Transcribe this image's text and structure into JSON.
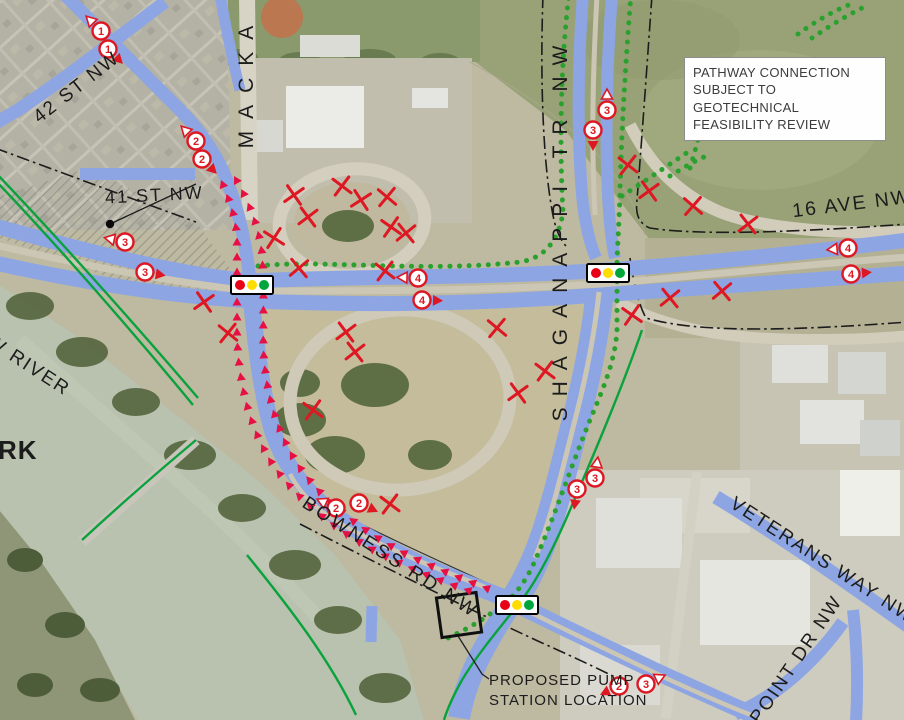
{
  "callout": {
    "lines": [
      "PATHWAY CONNECTION",
      "SUBJECT TO GEOTECHNICAL",
      "FEASIBILITY REVIEW"
    ]
  },
  "street_labels": {
    "st42": "42 ST NW",
    "st41": "41 ST NW",
    "mackay": "MACKA",
    "shaganappi": "SHAGANAPPI TR NW",
    "ave16": "16 AVE NW",
    "bowness": "BOWNESS RD NW",
    "veterans": "VETERANS WAY NW",
    "point": "POINT DR NW",
    "river": "W RIVER",
    "park": "RK"
  },
  "pump_label": {
    "line1": "PROPOSED PUMP",
    "line2": "STATION LOCATION"
  },
  "lane_markers": [
    {
      "n": "1",
      "x": 101,
      "y": 31,
      "a": 315,
      "s": "w"
    },
    {
      "n": "1",
      "x": 108,
      "y": 49,
      "a": 135,
      "s": "r"
    },
    {
      "n": "2",
      "x": 196,
      "y": 141,
      "a": 315,
      "s": "w"
    },
    {
      "n": "2",
      "x": 202,
      "y": 159,
      "a": 135,
      "s": "r"
    },
    {
      "n": "2",
      "x": 336,
      "y": 508,
      "a": 295,
      "s": "w"
    },
    {
      "n": "2",
      "x": 359,
      "y": 503,
      "a": 115,
      "s": "r"
    },
    {
      "n": "2",
      "x": 619,
      "y": 686,
      "a": 245,
      "s": "r"
    },
    {
      "n": "3",
      "x": 646,
      "y": 684,
      "a": 65,
      "s": "w"
    },
    {
      "n": "3",
      "x": 125,
      "y": 242,
      "a": 282,
      "s": "w"
    },
    {
      "n": "3",
      "x": 145,
      "y": 272,
      "a": 100,
      "s": "r"
    },
    {
      "n": "4",
      "x": 418,
      "y": 278,
      "a": 272,
      "s": "w"
    },
    {
      "n": "4",
      "x": 422,
      "y": 300,
      "a": 92,
      "s": "r"
    },
    {
      "n": "4",
      "x": 848,
      "y": 248,
      "a": 265,
      "s": "w"
    },
    {
      "n": "4",
      "x": 851,
      "y": 274,
      "a": 85,
      "s": "r"
    },
    {
      "n": "3",
      "x": 607,
      "y": 110,
      "a": 0,
      "s": "w"
    },
    {
      "n": "3",
      "x": 593,
      "y": 130,
      "a": 180,
      "s": "r"
    },
    {
      "n": "3",
      "x": 595,
      "y": 478,
      "a": 8,
      "s": "w"
    },
    {
      "n": "3",
      "x": 577,
      "y": 489,
      "a": 188,
      "s": "r"
    }
  ],
  "x_marks": [
    [
      294,
      195,
      10
    ],
    [
      342,
      186,
      -8
    ],
    [
      361,
      200,
      12
    ],
    [
      387,
      197,
      -5
    ],
    [
      308,
      217,
      8
    ],
    [
      391,
      227,
      -10
    ],
    [
      406,
      233,
      6
    ],
    [
      274,
      238,
      -12
    ],
    [
      299,
      268,
      5
    ],
    [
      385,
      271,
      -7
    ],
    [
      204,
      302,
      10
    ],
    [
      228,
      333,
      -6
    ],
    [
      346,
      332,
      8
    ],
    [
      313,
      410,
      -9
    ],
    [
      355,
      352,
      7
    ],
    [
      497,
      328,
      -5
    ],
    [
      518,
      393,
      9
    ],
    [
      545,
      371,
      -8
    ],
    [
      670,
      298,
      6
    ],
    [
      632,
      315,
      -10
    ],
    [
      722,
      291,
      5
    ],
    [
      628,
      165,
      -7
    ],
    [
      649,
      191,
      9
    ],
    [
      693,
      206,
      -4
    ],
    [
      748,
      224,
      7
    ],
    [
      390,
      504,
      -8
    ]
  ],
  "signals": [
    {
      "x": 252,
      "y": 285
    },
    {
      "x": 608,
      "y": 273
    },
    {
      "x": 517,
      "y": 605
    }
  ],
  "pump_square": {
    "x": 459,
    "y": 615,
    "size": 40,
    "rot": -8
  },
  "point_marker": {
    "x": 110,
    "y": 224
  },
  "colors": {
    "road_blue": "#8da5e3",
    "path_green": "#0aa23c",
    "dots_green": "#2aa12e",
    "route_pink": "#e61045",
    "mark_red": "#dd1823",
    "signal_red": "#e80016",
    "signal_yellow": "#ffdd00",
    "signal_green": "#00a63c"
  }
}
